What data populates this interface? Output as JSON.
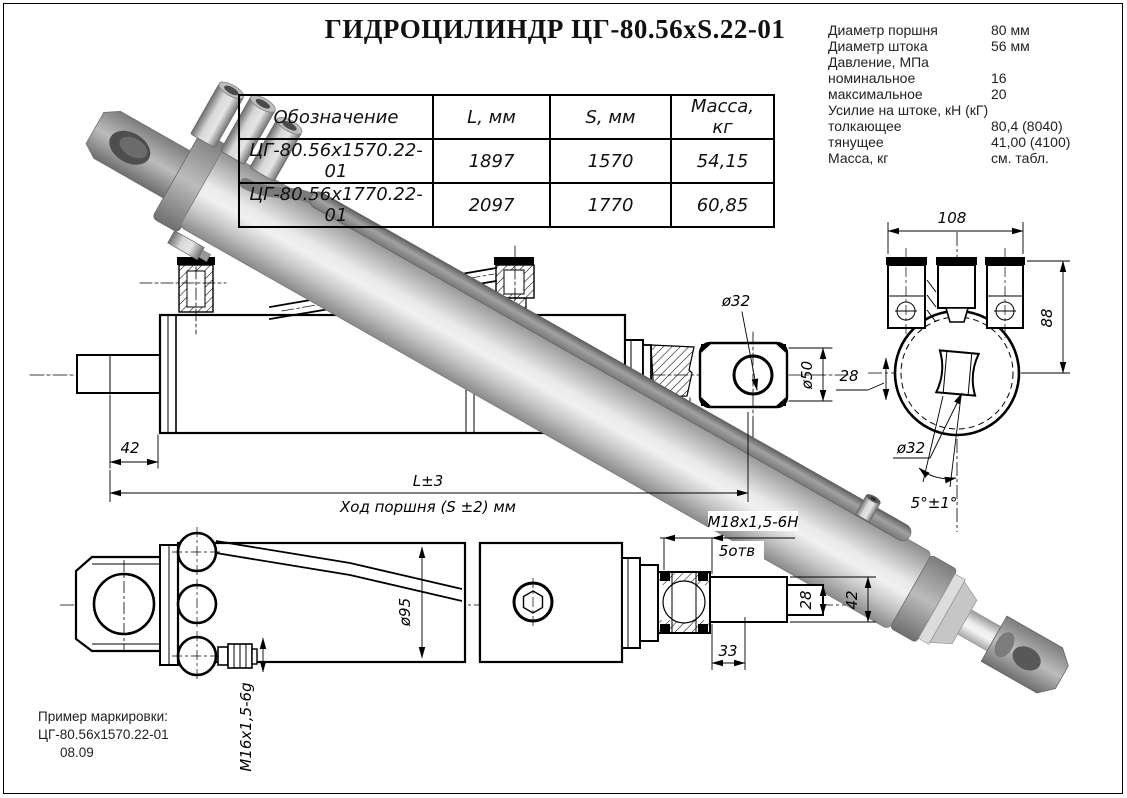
{
  "title": "ГИДРОЦИЛИНДР ЦГ-80.56xS.22-01",
  "specs": {
    "items": [
      {
        "label": "Диаметр поршня",
        "value": "80 мм"
      },
      {
        "label": "Диаметр штока",
        "value": "56 мм"
      },
      {
        "label": "Давление, МПа",
        "value": ""
      },
      {
        "label": "номинальное",
        "value": "16"
      },
      {
        "label": "максимальное",
        "value": "20"
      },
      {
        "label": "Усилие на штоке, кН (кГ)",
        "value": ""
      },
      {
        "label": "толкающее",
        "value": "80,4 (8040)"
      },
      {
        "label": "тянущее",
        "value": "41,00 (4100)"
      },
      {
        "label": "Масса, кг",
        "value": "см. табл."
      }
    ]
  },
  "table": {
    "headers": [
      "Обозначение",
      "L, мм",
      "S, мм",
      "Масса, кг"
    ],
    "rows": [
      [
        "ЦГ-80.56х1570.22-01",
        "1897",
        "1570",
        "54,15"
      ],
      [
        "ЦГ-80.56х1770.22-01",
        "2097",
        "1770",
        "60,85"
      ]
    ]
  },
  "dims": {
    "d42_left": "42",
    "dL": "L±3",
    "stroke_label": "Ход поршня (S ±2) мм",
    "d52": "52",
    "dia32_rod": "ø32",
    "dia50": "ø50",
    "d108": "108",
    "d88": "88",
    "d28_slot": "28",
    "dia32_end": "ø32",
    "angle5": "5°±1°",
    "m18": "М18х1,5-6Н",
    "m18_holes": "5отв",
    "d28_rod": "28",
    "d42_rod": "42",
    "d33": "33",
    "dia95": "ø95",
    "m16": "М16х1,5-6g"
  },
  "marking": {
    "line1": "Пример маркировки:",
    "line2": "ЦГ-80.56х1570.22-01",
    "line3": "08.09"
  },
  "colors": {
    "drawing_ink": "#000000",
    "render_gray": "#c9c9c9",
    "background": "#ffffff"
  }
}
